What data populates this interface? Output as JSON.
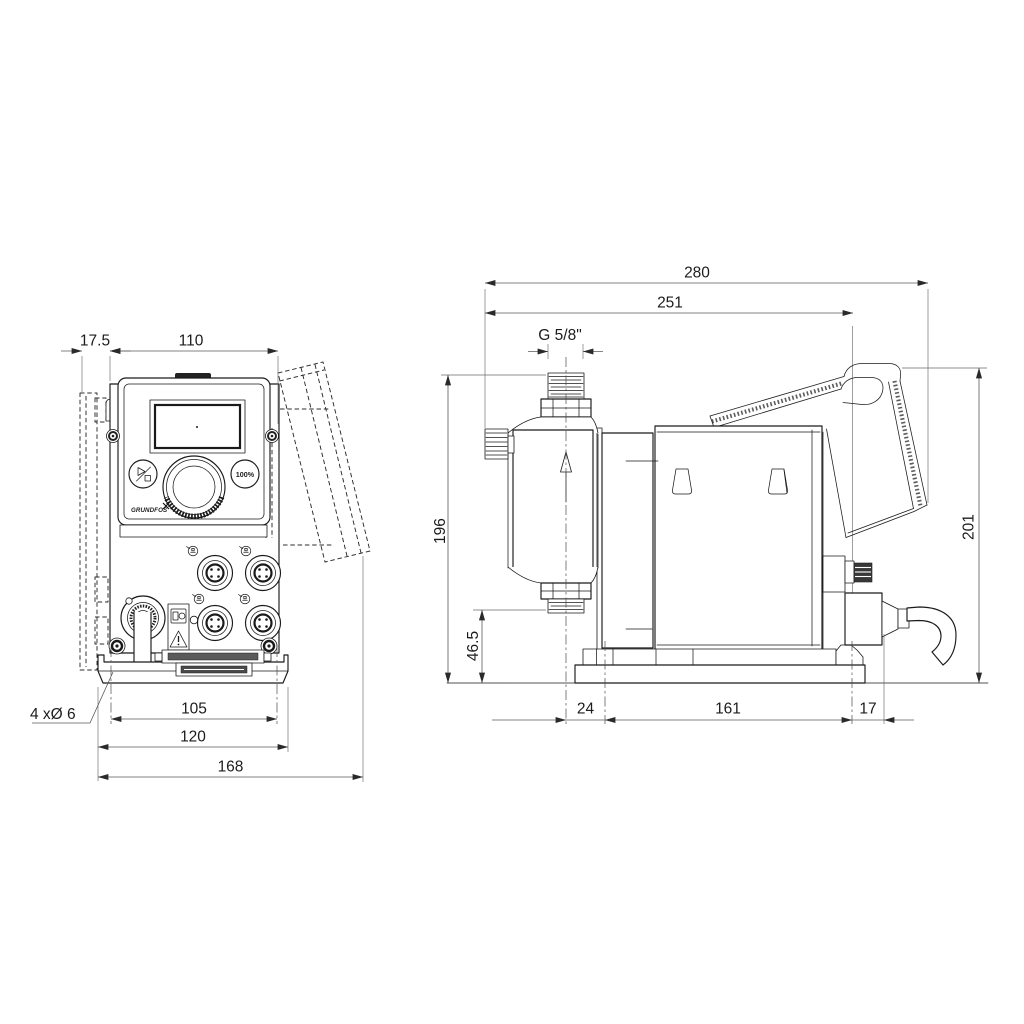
{
  "front_view": {
    "dims": {
      "wall_offset": "17.5",
      "body_width": "110",
      "hole_spacing": "105",
      "foot_width": "120",
      "overall_width": "168"
    },
    "hole_note": "4 xØ 6",
    "panel": {
      "boost_button": "100%",
      "brand": "GRUNDFOS"
    }
  },
  "side_view": {
    "dims": {
      "overall_depth": "280",
      "depth_to_mount": "251",
      "connection_thread": "G 5/8\"",
      "inlet_height": "196",
      "outlet_height": "46.5",
      "overall_height": "201",
      "front_hole_offset": "24",
      "hole_spacing": "161",
      "rear_hole_offset": "17"
    }
  },
  "colors": {
    "line": "#1a1a1a",
    "dimension": "#5a5a5a",
    "background": "#ffffff"
  }
}
